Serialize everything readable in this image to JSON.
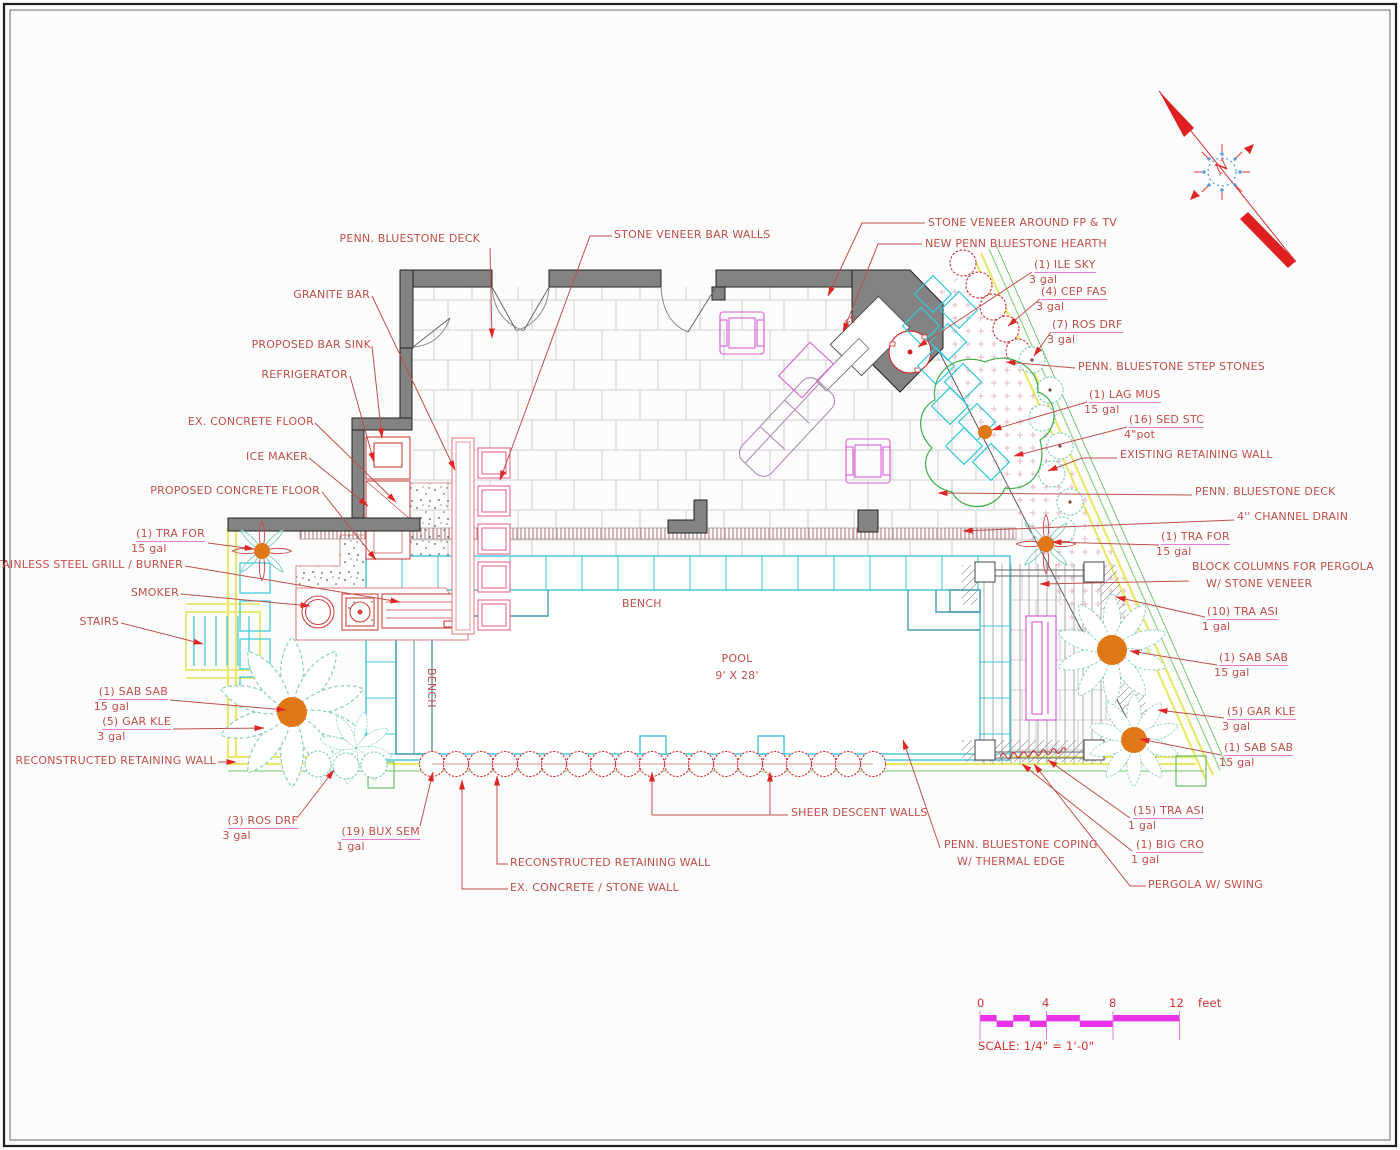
{
  "annotations": {
    "penn_deck_top": "PENN. BLUESTONE DECK",
    "granite_bar": "GRANITE BAR",
    "stone_veneer_bar_walls": "STONE VENEER BAR WALLS",
    "proposed_bar_sink": "PROPOSED BAR SINK",
    "refrigerator": "REFRIGERATOR",
    "ex_concrete_floor": "EX. CONCRETE FLOOR",
    "ice_maker": "ICE MAKER",
    "proposed_concrete_floor": "PROPOSED CONCRETE FLOOR",
    "grill": "STAINLESS STEEL GRILL / BURNER",
    "smoker": "SMOKER",
    "stairs": "STAIRS",
    "reconstructed_wall_left": "RECONSTRUCTED RETAINING WALL",
    "reconstructed_wall_bottom": "RECONSTRUCTED RETAINING WALL",
    "ex_concrete_stone_wall": "EX. CONCRETE / STONE WALL",
    "sheer_descent_walls": "SHEER DESCENT WALLS",
    "coping_line1": "PENN. BLUESTONE COPING",
    "coping_line2": "W/ THERMAL EDGE",
    "pergola_swing": "PERGOLA W/ SWING",
    "stone_veneer_fp": "STONE VENEER AROUND FP & TV",
    "hearth": "NEW PENN BLUESTONE HEARTH",
    "step_stones": "PENN. BLUESTONE STEP STONES",
    "existing_retaining_wall": "EXISTING RETAINING WALL",
    "penn_deck_right": "PENN. BLUESTONE DECK",
    "channel_drain": "4'' CHANNEL DRAIN",
    "block_columns_line1": "BLOCK COLUMNS FOR PERGOLA",
    "block_columns_line2": "W/ STONE VENEER"
  },
  "plants": {
    "ile_sky": {
      "name": "(1) ILE SKY",
      "size": "3 gal"
    },
    "cep_fas": {
      "name": "(4) CEP FAS",
      "size": "3 gal"
    },
    "ros_drf_7": {
      "name": "(7) ROS DRF",
      "size": "3 gal"
    },
    "lag_mus": {
      "name": "(1) LAG MUS",
      "size": "15 gal"
    },
    "sed_stc": {
      "name": "(16) SED STC",
      "size": "4\"pot"
    },
    "tra_for_right": {
      "name": "(1) TRA FOR",
      "size": "15 gal"
    },
    "tra_asi_10": {
      "name": "(10) TRA ASI",
      "size": "1 gal"
    },
    "sab_sab_r1": {
      "name": "(1) SAB SAB",
      "size": "15 gal"
    },
    "gar_kle_right": {
      "name": "(5) GAR KLE",
      "size": "3 gal"
    },
    "sab_sab_r2": {
      "name": "(1) SAB SAB",
      "size": "15 gal"
    },
    "tra_asi_15": {
      "name": "(15) TRA ASI",
      "size": "1 gal"
    },
    "big_cro": {
      "name": "(1) BIG CRO",
      "size": "1 gal"
    },
    "tra_for_left": {
      "name": "(1) TRA FOR",
      "size": "15 gal"
    },
    "sab_sab_left": {
      "name": "(1) SAB SAB",
      "size": "15 gal"
    },
    "gar_kle_left": {
      "name": "(5) GAR KLE",
      "size": "3 gal"
    },
    "ros_drf_3": {
      "name": "(3) ROS DRF",
      "size": "3 gal"
    },
    "bux_sem": {
      "name": "(19) BUX SEM",
      "size": "1 gal"
    }
  },
  "plan_text": {
    "pool": "POOL",
    "pool_size": "9' X 28'",
    "bench_top": "BENCH",
    "bench_side": "BENCH",
    "fireplace": "FP"
  },
  "scale_bar": {
    "tick0": "0",
    "tick4": "4",
    "tick8": "8",
    "tick12": "12",
    "unit": "feet",
    "caption": "SCALE: 1/4\" = 1'-0\""
  },
  "compass": {
    "north": "N"
  },
  "colors": {
    "label_red": "#c0504a",
    "arrow_red": "#e02525",
    "magenta": "#e832e8",
    "pool_cyan": "#3ec3da",
    "bench_blue": "#4a9ab5",
    "plant_teal": "#8fd0c0",
    "wall_yellow": "#e8e86a",
    "property_green": "#8fd483",
    "trunk_orange": "#e07818",
    "wall_gray": "#838383",
    "shrub_red": "#cc2222",
    "furniture_magenta": "#d95fd9"
  }
}
